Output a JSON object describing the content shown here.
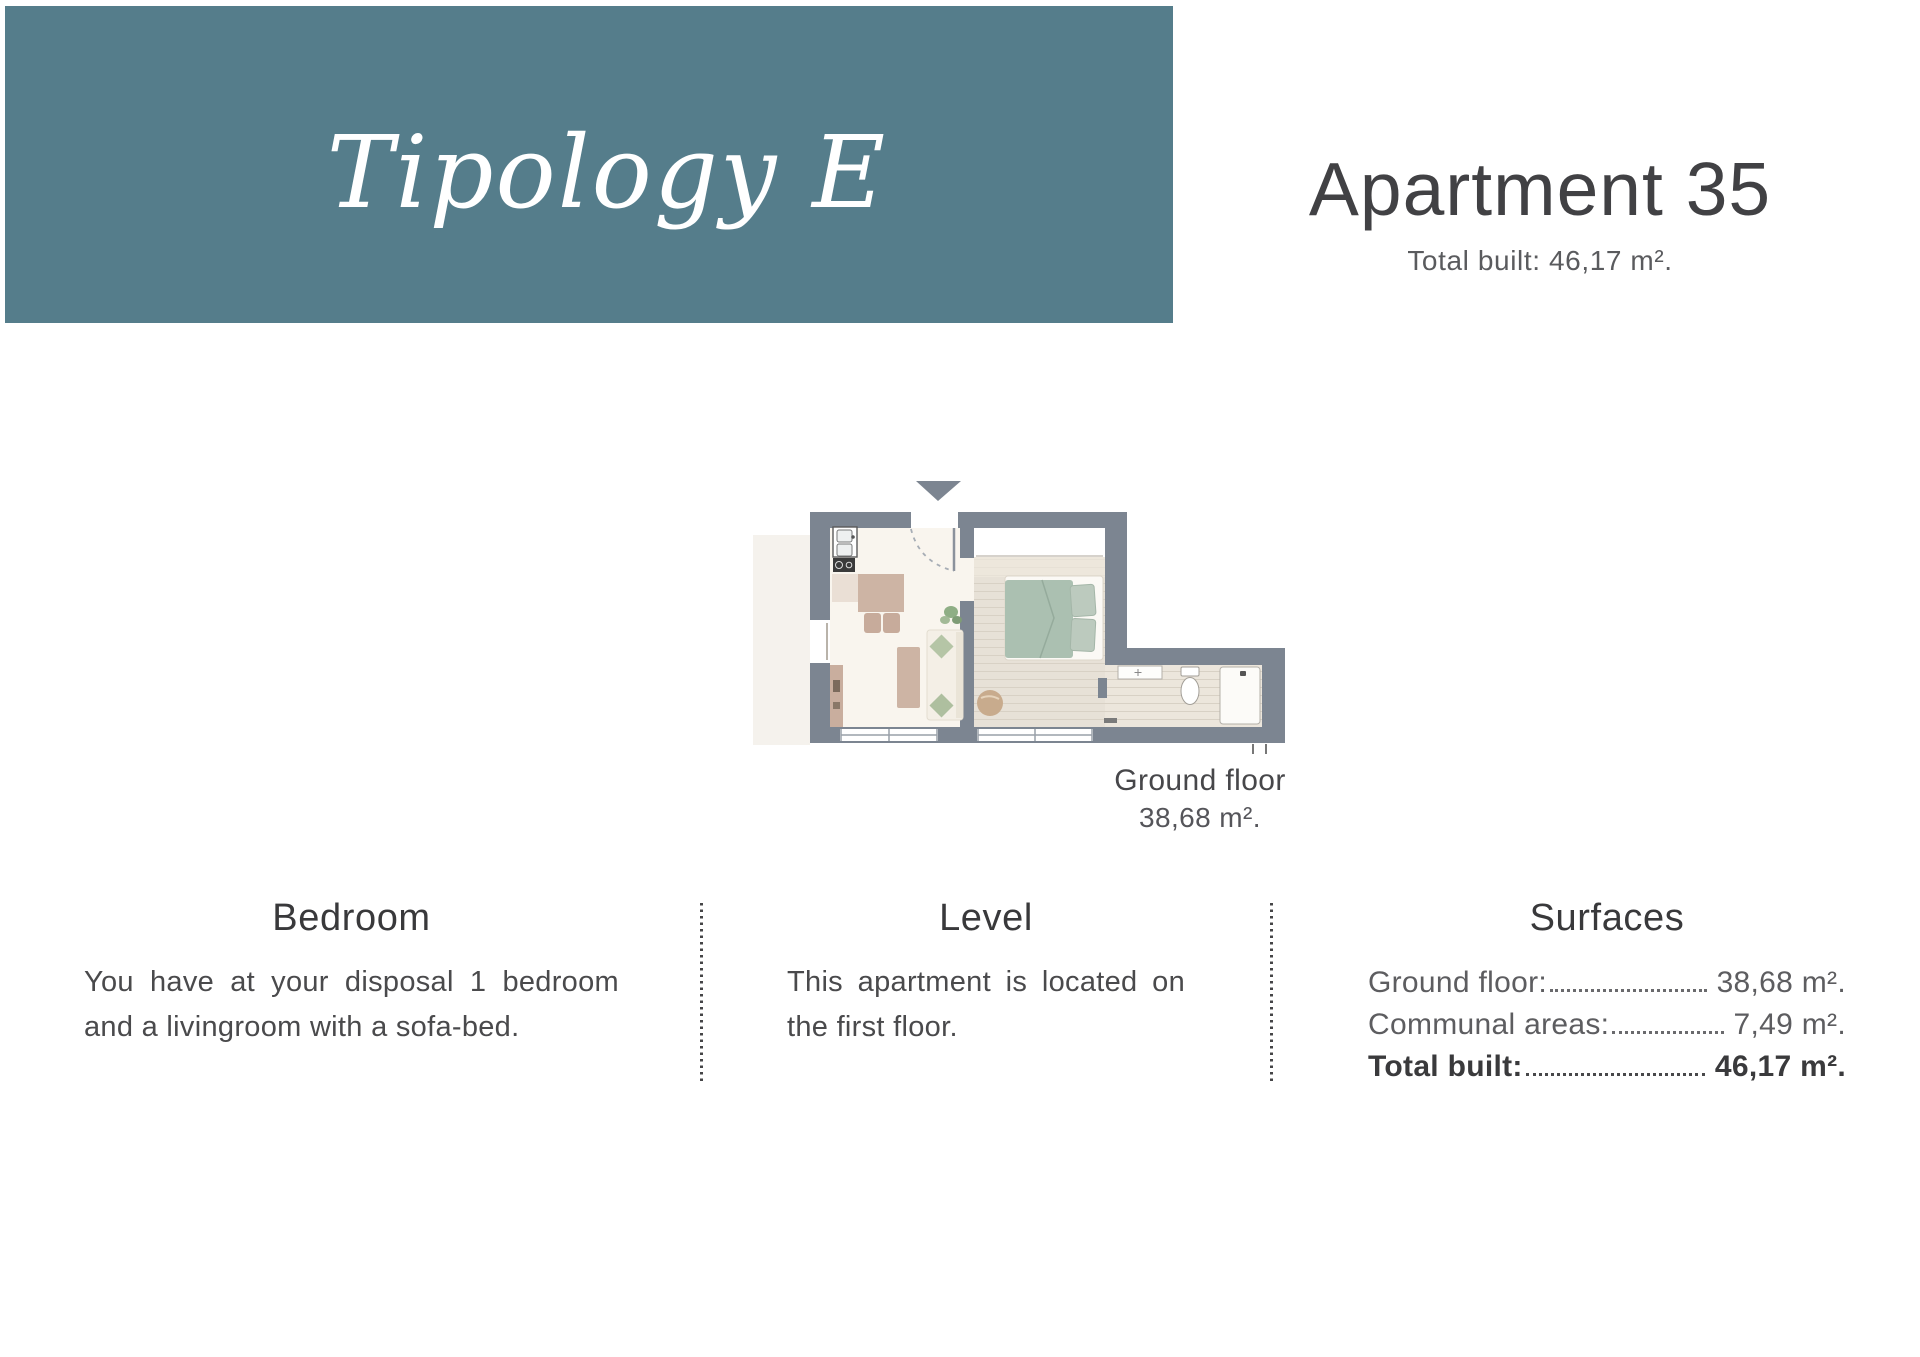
{
  "banner": {
    "title": "Tipology E",
    "bg_color": "#557d8b",
    "text_color": "#ffffff"
  },
  "header": {
    "title": "Apartment 35",
    "subtitle": "Total built: 46,17 m²."
  },
  "floor_plan": {
    "caption_title": "Ground floor",
    "caption_area": "38,68 m².",
    "icons": {
      "entrance_arrow": "triangle-down"
    },
    "colors": {
      "wall": "#7c8591",
      "living_floor": "#f9f5ee",
      "bedroom_floor": "#e7e1d7",
      "corridor_floor": "#ece6dc",
      "neighbor_area": "#ede7de",
      "bed_duvet": "#abc0b1",
      "pillow": "#bccabe",
      "wood_furniture": "#cdb4a4",
      "sofa": "#f4efe6",
      "cushion": "#b5c5a6",
      "pouf": "#c8ab8d",
      "plant": "#8fae85"
    }
  },
  "columns": [
    {
      "heading": "Bedroom",
      "body": "You have at your disposal 1 bedroom and a livingroom with a sofa-bed."
    },
    {
      "heading": "Level",
      "body": "This apartment is located on the first floor."
    },
    {
      "heading": "Surfaces",
      "rows": [
        {
          "label": "Ground floor:",
          "value": "38,68 m²."
        },
        {
          "label": "Communal areas:",
          "value": "7,49 m²."
        },
        {
          "label": "Total built:",
          "value": "46,17 m²."
        }
      ]
    }
  ]
}
